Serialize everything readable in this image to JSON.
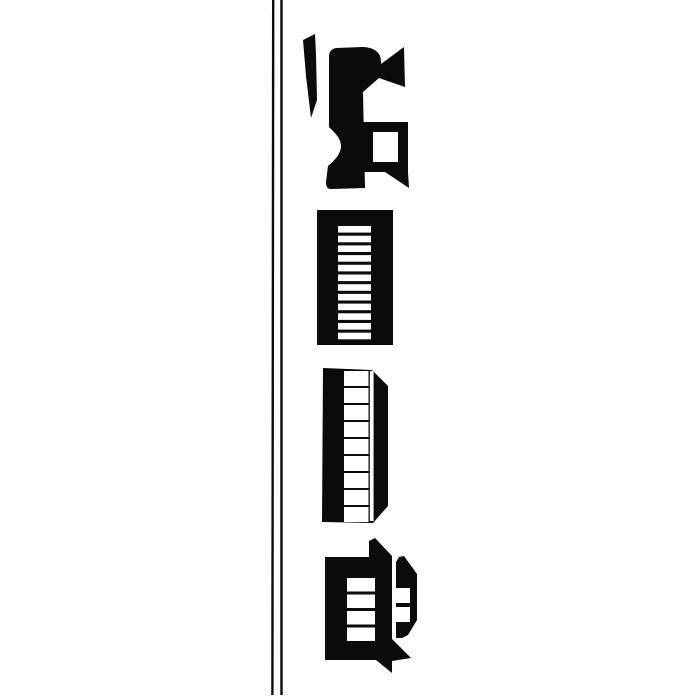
{
  "canvas": {
    "width": 700,
    "height": 700,
    "background": "#ffffff",
    "ink": "#0b0b0b",
    "paper": "#ffffff"
  },
  "illustration": {
    "name": "vertical-train-woodcut",
    "subject": "steam locomotive, slatted boxcar, windowed coach and caboose with cupola, drawn rotated vertically beside a double rail line",
    "elements": [
      {
        "name": "rail-line-outer",
        "type": "line",
        "x1": 273.2,
        "y1": 0,
        "x2": 272.4,
        "y2": 695,
        "stroke_width": 2.4
      },
      {
        "name": "rail-line-inner",
        "type": "line",
        "x1": 281.5,
        "y1": 0,
        "x2": 281.5,
        "y2": 695,
        "stroke_width": 2.4
      },
      {
        "name": "locomotive-pilot-blade",
        "type": "path",
        "d": "M315,34 L303,40 L306,76 L311,118 L317,100 L316,54 Z"
      },
      {
        "name": "locomotive-boiler",
        "type": "path",
        "d": "M336,48 L362,47 C372,47 378,51 380,56 C381,59 381,61 381,64 L404,47 L405,87 L379,78 L363,92 L365,188 L331,189 C327,189 326,186 326,182 L328,166 C334,161 341,154 341,146 C341,138 334,132 329,127 L329,57 C329,52 331,49 336,48 Z"
      },
      {
        "name": "locomotive-cab-frame",
        "type": "path",
        "fill_rule": "evenodd",
        "d": "M363,122 L408,122 L408,172 L363,172 Z M373,132 L398,132 L398,162 L373,162 Z"
      },
      {
        "name": "locomotive-cab-eave",
        "type": "path",
        "d": "M385,172 L408,172 L409,188 Z"
      },
      {
        "name": "boxcar-body",
        "type": "path",
        "d": "M317,210 L393,210 L393,345 L317,345 Z"
      },
      {
        "name": "boxcar-slat",
        "type": "repeat-rect",
        "fill": "#ffffff",
        "x": 338,
        "width": 33,
        "y_start": 226,
        "count": 12,
        "item_height": 6.6,
        "gap": 3.1
      },
      {
        "name": "coach-body",
        "type": "path",
        "d": "M323,368 L372,370 L388,386 L388,506 L373,523 L322,522 Z"
      },
      {
        "name": "coach-window",
        "type": "repeat-rect",
        "fill": "#ffffff",
        "x": 344,
        "width": 24.5,
        "y_start": 371,
        "count": 9,
        "item_height": 15,
        "gap": 2
      },
      {
        "name": "coach-side-strip",
        "type": "rect",
        "fill": "#ffffff",
        "x": 369.8,
        "y": 371,
        "width": 3.8,
        "height": 150
      },
      {
        "name": "caboose-body",
        "type": "path",
        "d": "M325,557 L369,557 L369,541 L375,538 L392,556 L392,660 L325,660 Z"
      },
      {
        "name": "caboose-window",
        "type": "repeat-rect",
        "fill": "#ffffff",
        "x": 347,
        "width": 28,
        "y_start": 578,
        "count": 4,
        "item_height": 13.5,
        "gap": 3
      },
      {
        "name": "caboose-cupola",
        "type": "path",
        "d": "M396,638 L396,562 L399,557 L404,556 L417,574 L417,620 L408,635 L402,638 Z"
      },
      {
        "name": "caboose-cupola-window",
        "type": "repeat-rect",
        "fill": "#ffffff",
        "x": 396,
        "width": 14,
        "y_start": 588,
        "count": 2,
        "item_height": 15,
        "gap": 4
      },
      {
        "name": "caboose-roof-lower",
        "type": "path",
        "d": "M392,639 L411,658 L392,661 Z"
      },
      {
        "name": "caboose-skirt",
        "type": "path",
        "d": "M376,660 L392,660 L392,673 Z"
      }
    ]
  }
}
